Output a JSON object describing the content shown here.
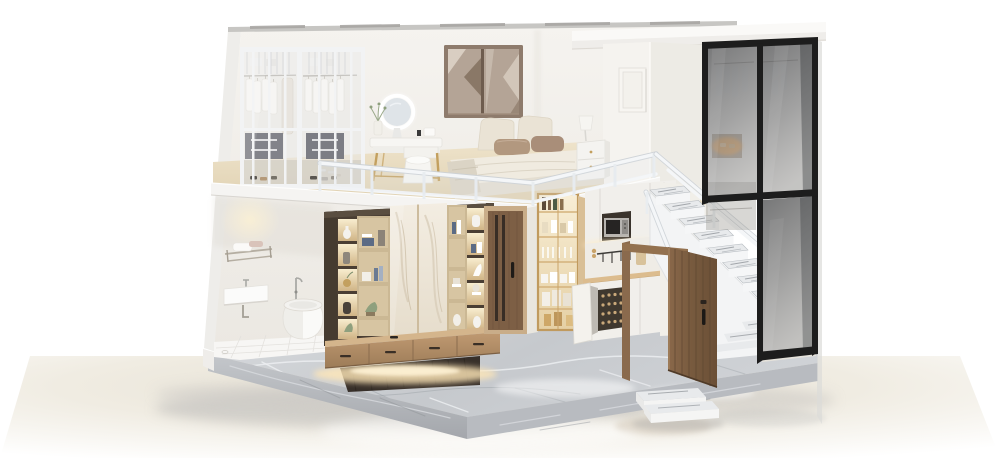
{
  "scene": {
    "title": "3D cutaway render of a two-story loft apartment on a marble plinth",
    "style": "photorealistic dollhouse section view, white studio background",
    "areas": [
      {
        "id": "mezzanine-wardrobe",
        "label": "Glass-front wardrobe with hanging white clothes"
      },
      {
        "id": "vanity",
        "label": "Vanity table with round LED mirror and pouf"
      },
      {
        "id": "bedroom",
        "label": "Mezzanine bedroom with low bed, brown pillows, nightstand and lamp"
      },
      {
        "id": "bronze-window",
        "label": "Bronze-framed mirrored window"
      },
      {
        "id": "picture-frame",
        "label": "Blank white picture frame"
      },
      {
        "id": "mezzanine-railing",
        "label": "White metal and glass guard railing"
      },
      {
        "id": "bathroom",
        "label": "Bathroom with towel rack, wall sink and freestanding tub"
      },
      {
        "id": "feature-wall",
        "label": "Bronze display wall with lit shelves, marble panels and floating media console"
      },
      {
        "id": "interior-door",
        "label": "Closed walnut interior door"
      },
      {
        "id": "kitchenette",
        "label": "Kitchenette with gold glass cabinet, microwave, wood counter and wine rack"
      },
      {
        "id": "staircase",
        "label": "White staircase with grey marble treads"
      },
      {
        "id": "glass-box",
        "label": "Smoked-glass closet enclosure with black frames"
      },
      {
        "id": "entry-door",
        "label": "Open walnut entry door"
      },
      {
        "id": "entry-steps",
        "label": "White entry steps with marble tops"
      },
      {
        "id": "platform",
        "label": "Grey marble base platform on glossy studio floor"
      }
    ]
  },
  "palette": {
    "wall": "#f3f1ed",
    "wallShade": "#e9e6e0",
    "wallOuter": "#eeedea",
    "topStrip": "#c7c6c3",
    "cornice": "#faf9f7",
    "mezzFloor": "#e9ddc3",
    "fascia": "#f5f4f2",
    "railWhite": "#f4f6f8",
    "railShadow": "#ccd1d6",
    "wardrobeFrame": "#f2f3f4",
    "clothesWhite": "#f6f5f3",
    "bronze": "#4a3e33",
    "bronzeDark": "#38302a",
    "shelfGlow": "#f4e6c3",
    "shelfWood": "#d7c5a2",
    "marblePanel": "#f0e9dd",
    "marbleVein": "#d2c5ae",
    "consoleWood": "#b08c67",
    "consoleTop": "#d4b58c",
    "doorWood": "#7d5f45",
    "doorDark": "#5e4631",
    "gold": "#c3a05f",
    "goldFrame": "#c09a5e",
    "cabinetGlow": "#f6ebd1",
    "kitchenWhite": "#f1efeb",
    "counterWood": "#dcbc8e",
    "rackDark": "#3f382f",
    "stairTread": "#e8eaec",
    "stairWhite": "#f3f4f5",
    "glassSmoke": "#4a4c50",
    "glassFrame": "#1d1d1d",
    "platTop": "#cdd0d3",
    "platFace": "#b5b8bd",
    "platVein": "#eef0f2",
    "tile": "#f7f6f4",
    "grout": "#e2e0dc",
    "ground": "#ece7dc",
    "shadow": "#c8c6c2",
    "windowBronze": "#8e7b6c",
    "windowGlass": "#b4a496",
    "bedLinen": "#f0ebe0",
    "cushion": "#eae3d5",
    "pillowBrown": "#b2987f",
    "mirrorFace": "#dfe4e8",
    "warmGlow": "#ffedc2",
    "plantGreen": "#8fa07e"
  }
}
